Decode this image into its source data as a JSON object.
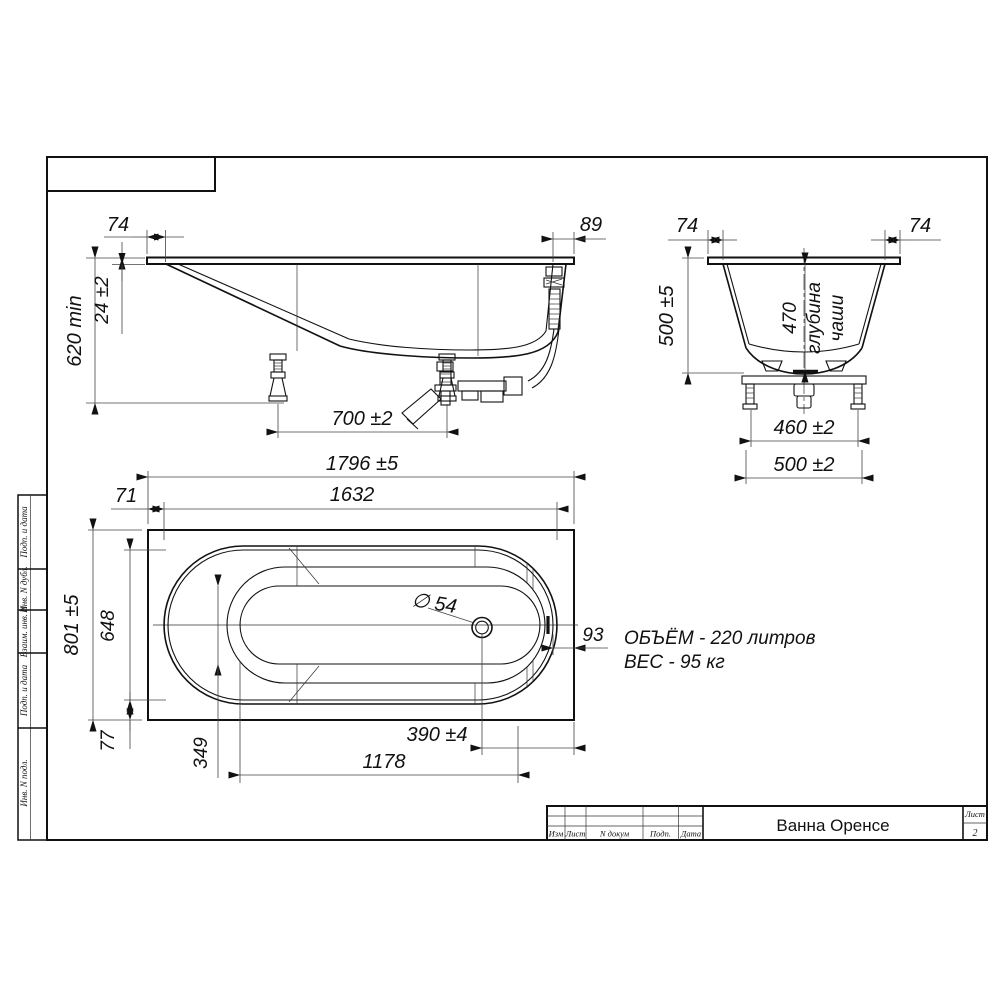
{
  "title_block": {
    "title": "Ванна Оренсе",
    "sheet_label": "Лист",
    "sheet_number": "2",
    "col_izm": "Изм",
    "col_list": "Лист",
    "col_ndokum": "N докум",
    "col_podp": "Подп.",
    "col_data": "Дата"
  },
  "margin_column": {
    "cell_1": "Подп. и дата",
    "cell_2": "Инв. N дубл.",
    "cell_3": "Взаим. инв. N",
    "cell_4": "Подп. и дата",
    "cell_5": "Инв. N подл."
  },
  "side_view": {
    "rim_overhang_left": "74",
    "rim_overhang_right": "89",
    "rim_thickness": "24 ±2",
    "install_height": "620 min",
    "leg_spacing": "700 ±2"
  },
  "end_view": {
    "rim_overhang_left": "74",
    "rim_overhang_right": "74",
    "overall_height": "500 ±5",
    "bowl_depth_value": "470",
    "bowl_depth_word1": "глубина",
    "bowl_depth_word2": "чаши",
    "frame_span": "460 ±2",
    "base_span": "500 ±2"
  },
  "plan_view": {
    "overall_length": "1796 ±5",
    "inner_length": "1632",
    "end_offset": "71",
    "overall_width": "801 ±5",
    "inner_width": "648",
    "side_offset": "77",
    "bottom_width": "349",
    "drain_offset": "390 ±4",
    "bottom_length": "1178",
    "right_offset": "93",
    "drain_diameter": "∅ 54"
  },
  "notes": {
    "volume": "ОБЪЁМ - 220 литров",
    "weight": "ВЕС - 95 кг"
  }
}
